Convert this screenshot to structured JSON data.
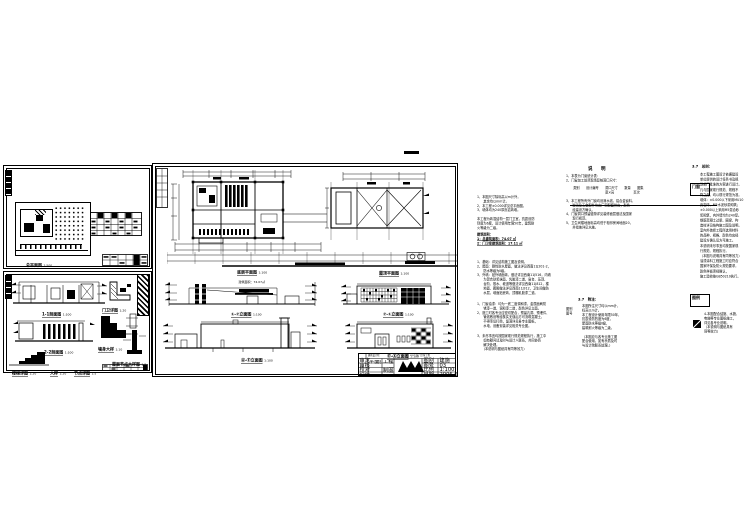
{
  "labels": {
    "site_plan": {
      "title": "总平面图",
      "scale": "1:500"
    },
    "floor_plan": {
      "title": "底层平面图",
      "scale": "1:100",
      "sub": "建筑面积：74.07㎡"
    },
    "roof_plan": {
      "title": "屋顶平面图",
      "scale": "1:100"
    },
    "elev_1": {
      "title": "①-⑦立面图",
      "scale": "1:100"
    },
    "elev_2": {
      "title": "⑦-①立面图",
      "scale": "1:100"
    },
    "elev_3": {
      "title": "Ⓐ-Ⓔ立面图",
      "scale": "1:100"
    },
    "elev_4": {
      "title": "Ⓔ-Ⓐ立面图",
      "scale": "1:100"
    },
    "section_1": {
      "title": "1-1剖面图",
      "scale": "1:100"
    },
    "section_2": {
      "title": "2-2剖面图",
      "scale": "1:100"
    },
    "detail_guard": {
      "title": "门卫详图",
      "scale": "1:20"
    },
    "detail_wall": {
      "title": "墙身大样",
      "scale": "1:10"
    },
    "detail_roofnode": {
      "title": "屋面节点大样图",
      "scale": "1:5"
    },
    "detail_stair": {
      "title": "楼梯详图",
      "scale": "1:20"
    },
    "detail_sample": {
      "title": "大样",
      "scale": "1:20"
    },
    "detail_node": {
      "title": "节点详图",
      "scale": "1:5"
    }
  },
  "title_block": {
    "company": "建筑设计院",
    "project": "××厂区门卫室工程",
    "drawing_name": "平面图·立面图·剖面图",
    "rows": {
      "r1": "审定",
      "r2": "审核",
      "r3": "校对",
      "r4": "设计"
    },
    "mid": {
      "m1": "工程负责",
      "m2": "制图"
    },
    "fields": {
      "f1": "图别",
      "v1": "建施",
      "f2": "图号",
      "v2": "03",
      "f3": "比例",
      "v3": "1:100",
      "f4": "日期",
      "v4": "2006.6"
    }
  },
  "notes_a": {
    "b1": [
      "1、本图尺寸除标高以m计外，",
      "　　其余均以mm计。",
      "2、本工程±0.000详见总平面图。",
      "3、墙体均为240厚页岩砖墙。"
    ],
    "b2": [
      "本工程为砖混结构一层门卫室，抗震设防",
      "烈度为6度，设计使用年限50年，建筑耐",
      "火等级为二级。"
    ],
    "area_title": "建筑面积：",
    "area": [
      "1：总建筑面积：74.07 ㎡",
      "2：门卫室建筑面积：17.11 ㎡"
    ],
    "b3": [
      "1、基础：详见结构施工图及说明。",
      "2、屋面：刚性防水屋面，做法详见西南11J201-2，",
      "　　防水等级为Ⅱ级。",
      "3、外墙：贴外墙面砖，做法详见西南11J516，内墙",
      "　　为混合砂浆抹面、乳胶漆二道，窗台、压顶、",
      "　　台阶、散水、坡道等做法详见西南11J812，楼",
      "　　地面、踢脚做法详见西南11J312，卫生间做防",
      "　　水层，墙面贴瓷砖，顶棚乳胶漆二道。"
    ],
    "b4": [
      "1、门窗油漆：均为一底二度调和漆，金属面刷防",
      "　　锈漆一道、调和漆二道，颜色详见立面。",
      "2、施工时各专业应密切配合，预留孔洞、预埋件、",
      "　　管线敷设等经核实无误后方可浇筑混凝土，",
      "　　不得事后打凿，留洞详见各专业图纸，",
      "　　水电、设备安装详见相关专业图。"
    ],
    "b5": [
      "3、未尽事宜均按国家现行规范规程执行，施工中",
      "　　如有疑问请及时与设计人联系，共同协商",
      "　　解决处理。",
      "　　（本说明与图纸具有同等效力）"
    ]
  },
  "notes_b": {
    "header": "说　明",
    "list1": [
      "1、本表为门窗统计表：",
      "2、门窗加工前须现场复核洞口尺寸："
    ],
    "table": [
      "　类别　　设计编号　　洞口尺寸　　数量　　图集",
      "　　　　　　　　　　　宽×高　　　　　　页次"
    ],
    "list2": [
      "3、本工程所有外门窗均设滴水线，铝合金窗料、",
      "　　玻璃及五金配件均由厂家配套供应，颜色",
      "　　经建设方确认。",
      "4、门窗洞口预留缝隙详见装修面层做法及国家",
      "　　现行规范。",
      "5、卫生间楼地面标高均低于相邻房间地面20，",
      "　　并找坡详见水施。"
    ]
  },
  "notes_b2": {
    "side": [
      "图别",
      "图号"
    ],
    "header": "3.7　附注：",
    "lines": [
      "本图所注尺寸均以mm计，",
      "标高以m计。",
      "本工程设计使用年限50年，",
      "抗震设防烈度为6度，",
      "屋面防水等级Ⅱ级，",
      "建筑耐火等级为二级。",
      "",
      "（本图应与各专业施工图",
      "配合使用，如有矛盾及时",
      "与设计院联系处理。）"
    ]
  },
  "notes_c": {
    "header": "3.7　总则：",
    "tag": "门窗",
    "lines": [
      "本工程施工图设计依据建设",
      "单位提供的设计任务书及规",
      "划部门批准的方案进行设计。",
      "凡与国家现行规范、规程不",
      "符之处，均以现行规范为准。",
      "墙体：±0.000以下采用MU10",
      "页岩砖、M5水泥砂浆砌筑；",
      "±0.000以上采用M5混合砂",
      "浆砌筑，内外墙均为240厚。",
      "钢筋混凝土过梁、圈梁、构",
      "造柱详见结构施工图及说明。",
      "室内外装修工程所选用材料",
      "的品种、规格、颜色均应经",
      "建设方确认后方可施工。",
      "本说明未尽事宜均按国家现",
      "行规范、规程执行。",
      "（本图与说明具有同等效力）",
      "油漆涂料工程施工时应符合",
      "国家环保及防火规范要求，",
      "颜色样板须经确认，",
      "施工验收按GB50210执行。"
    ]
  },
  "notes_c2": {
    "tag": "图例",
    "lines": [
      "4-本图配合结施、水施、",
      "电施等专业图纸施工，",
      "详见各专业说明。",
      "（本说明与图纸具有",
      "同等效力）"
    ]
  }
}
